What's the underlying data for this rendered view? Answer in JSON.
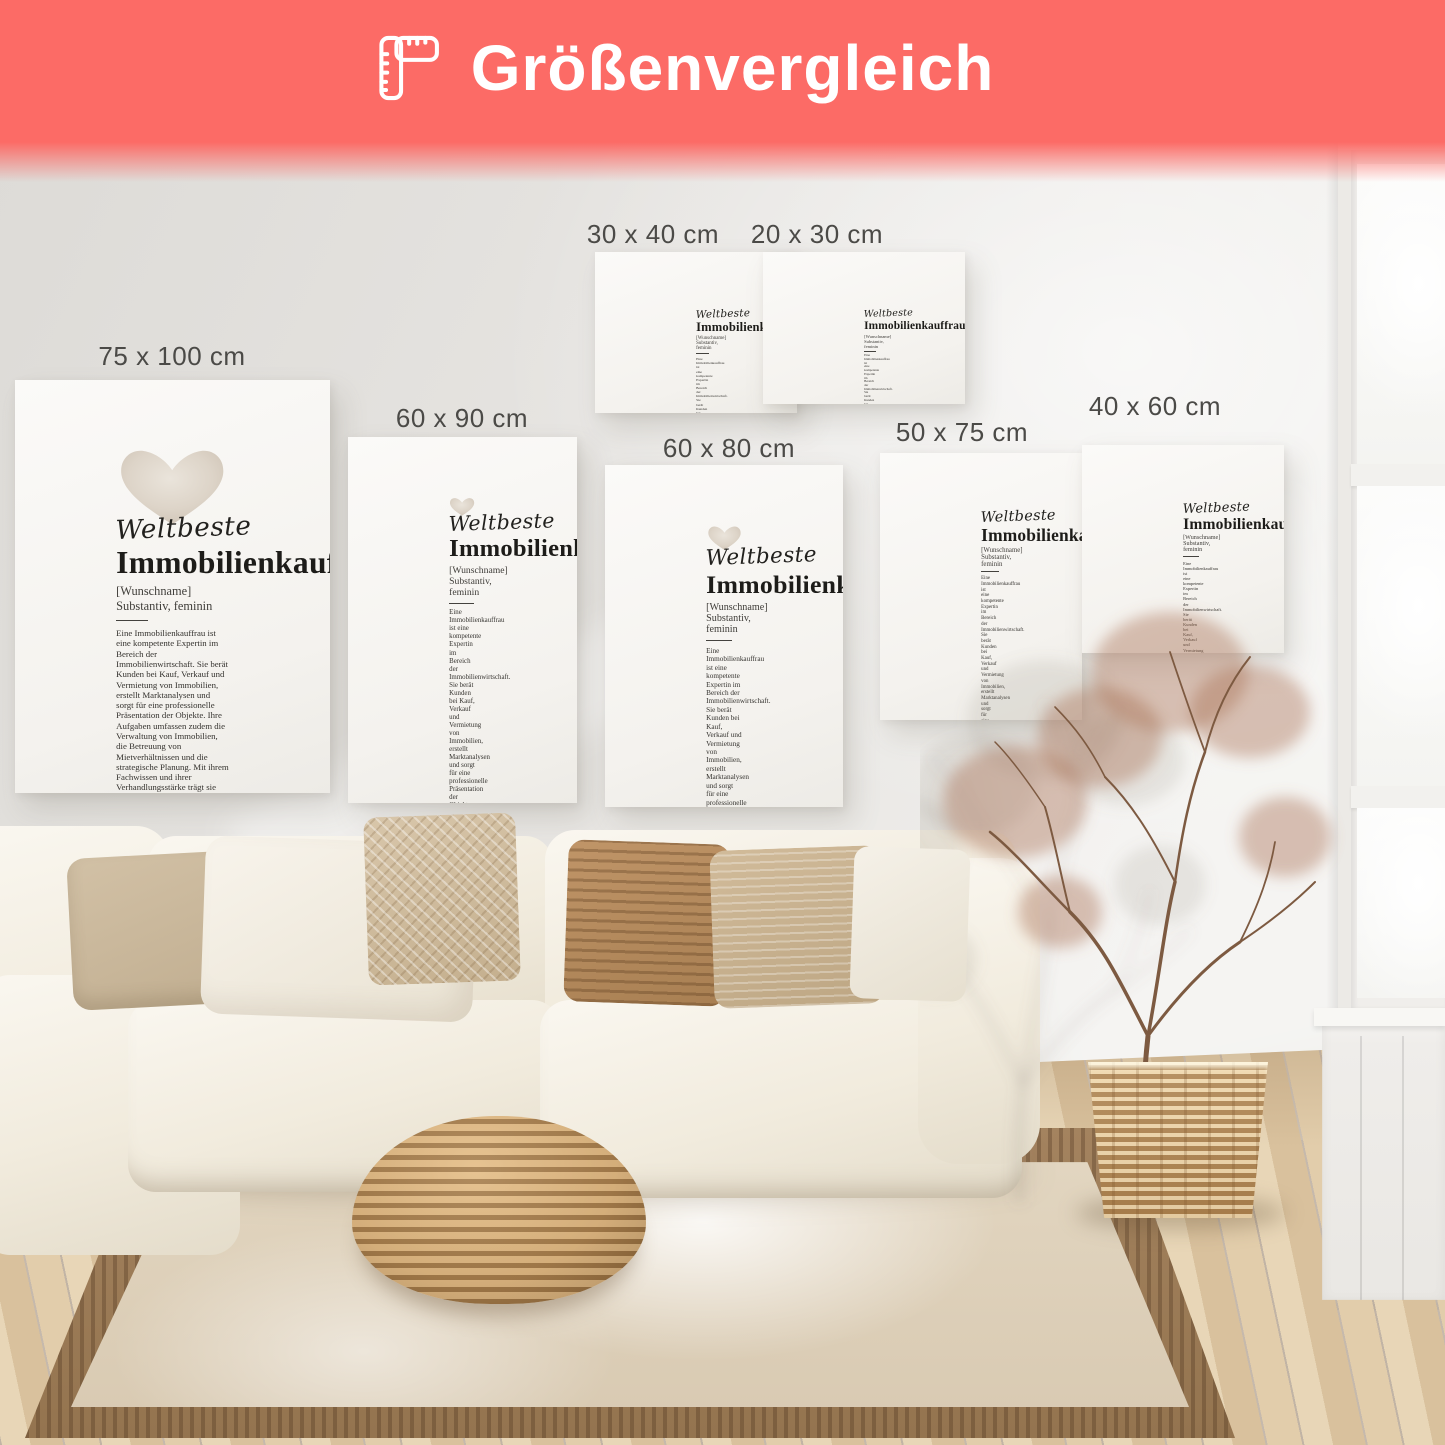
{
  "header": {
    "title": "Größenvergleich",
    "banner_color": "#fc6b66",
    "icon": "folding-ruler-icon"
  },
  "poster_content": {
    "script_title": "Weltbeste",
    "main_title": "Immobilienkauffrau",
    "subtitle": "[Wunschname] Substantiv, feminin",
    "body": "Eine Immobilienkauffrau ist eine kompetente Expertin im Bereich der Immobilienwirtschaft. Sie berät Kunden bei Kauf, Verkauf und Vermietung von Immobilien, erstellt Marktanalysen und sorgt für eine professionelle Präsentation der Objekte. Ihre Aufgaben umfassen zudem die Verwaltung von Immobilien, die Betreuung von Mietverhältnissen und die strategische Planung. Mit ihrem Fachwissen und ihrer Verhandlungsstärke trägt sie entscheidend zum Erfolg in der Immobilienbranche bei.",
    "synonyms_label": "Synonyme:",
    "synonyms": "Immobilienexpertin, Wohnraumgestalterin, Immobilienberaterin, Immobilienvermittlerin."
  },
  "sizes": [
    {
      "label": "75 x 100 cm"
    },
    {
      "label": "60 x 90 cm"
    },
    {
      "label": "30 x 40 cm"
    },
    {
      "label": "20 x 30 cm"
    },
    {
      "label": "60 x 80 cm"
    },
    {
      "label": "50 x 75 cm"
    },
    {
      "label": "40 x 60 cm"
    }
  ],
  "scene": {
    "description": "Bright living room with cream sectional sofa, beige pillows, rattan pouf, jute rug, dried branch plant in woven basket, tall white window",
    "heart_color": "#d5cabc",
    "label_text_color": "#4b4a47"
  }
}
